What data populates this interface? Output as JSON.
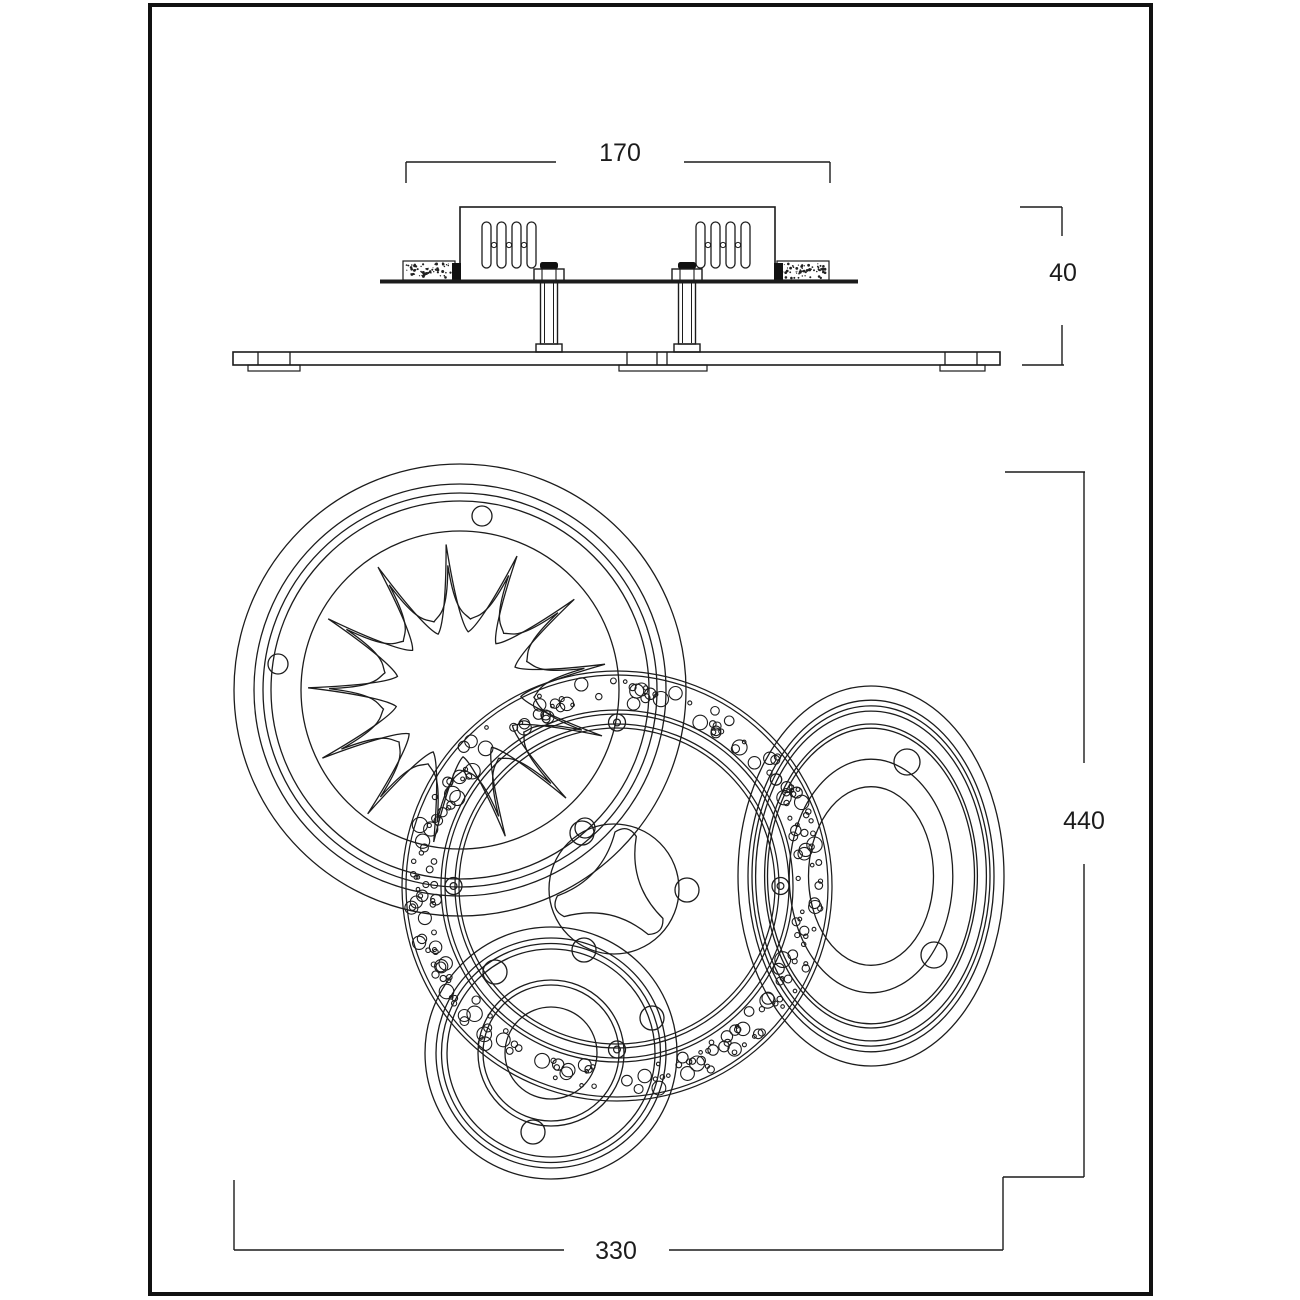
{
  "page": {
    "background": "#ffffff",
    "line_color": "#1c1c1c",
    "kind": "technical-dimension-drawing"
  },
  "drawing": {
    "dimension_labels": {
      "housing_width": "170",
      "recess_height": "40",
      "overall_height": "440",
      "overall_width": "330"
    }
  }
}
